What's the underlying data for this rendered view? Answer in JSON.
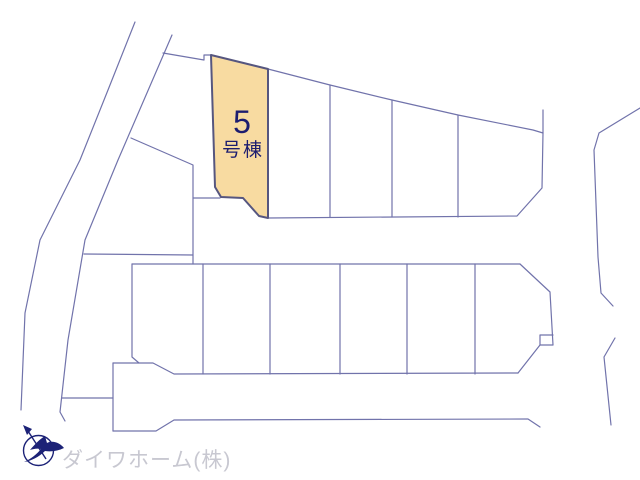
{
  "map": {
    "highlighted_lot": {
      "number": "5",
      "suffix": "号棟"
    },
    "watermark_company": "ダイワホーム(株)",
    "icons": {
      "logo": "compass-bird-north-icon"
    }
  },
  "colors": {
    "line": "#7173ab",
    "lot_fill": "#f8dba1",
    "lot_stroke": "#56567f",
    "label_text": "#1d1d6f",
    "watermark": "#c8c8d1",
    "logo": "#1c2277"
  }
}
